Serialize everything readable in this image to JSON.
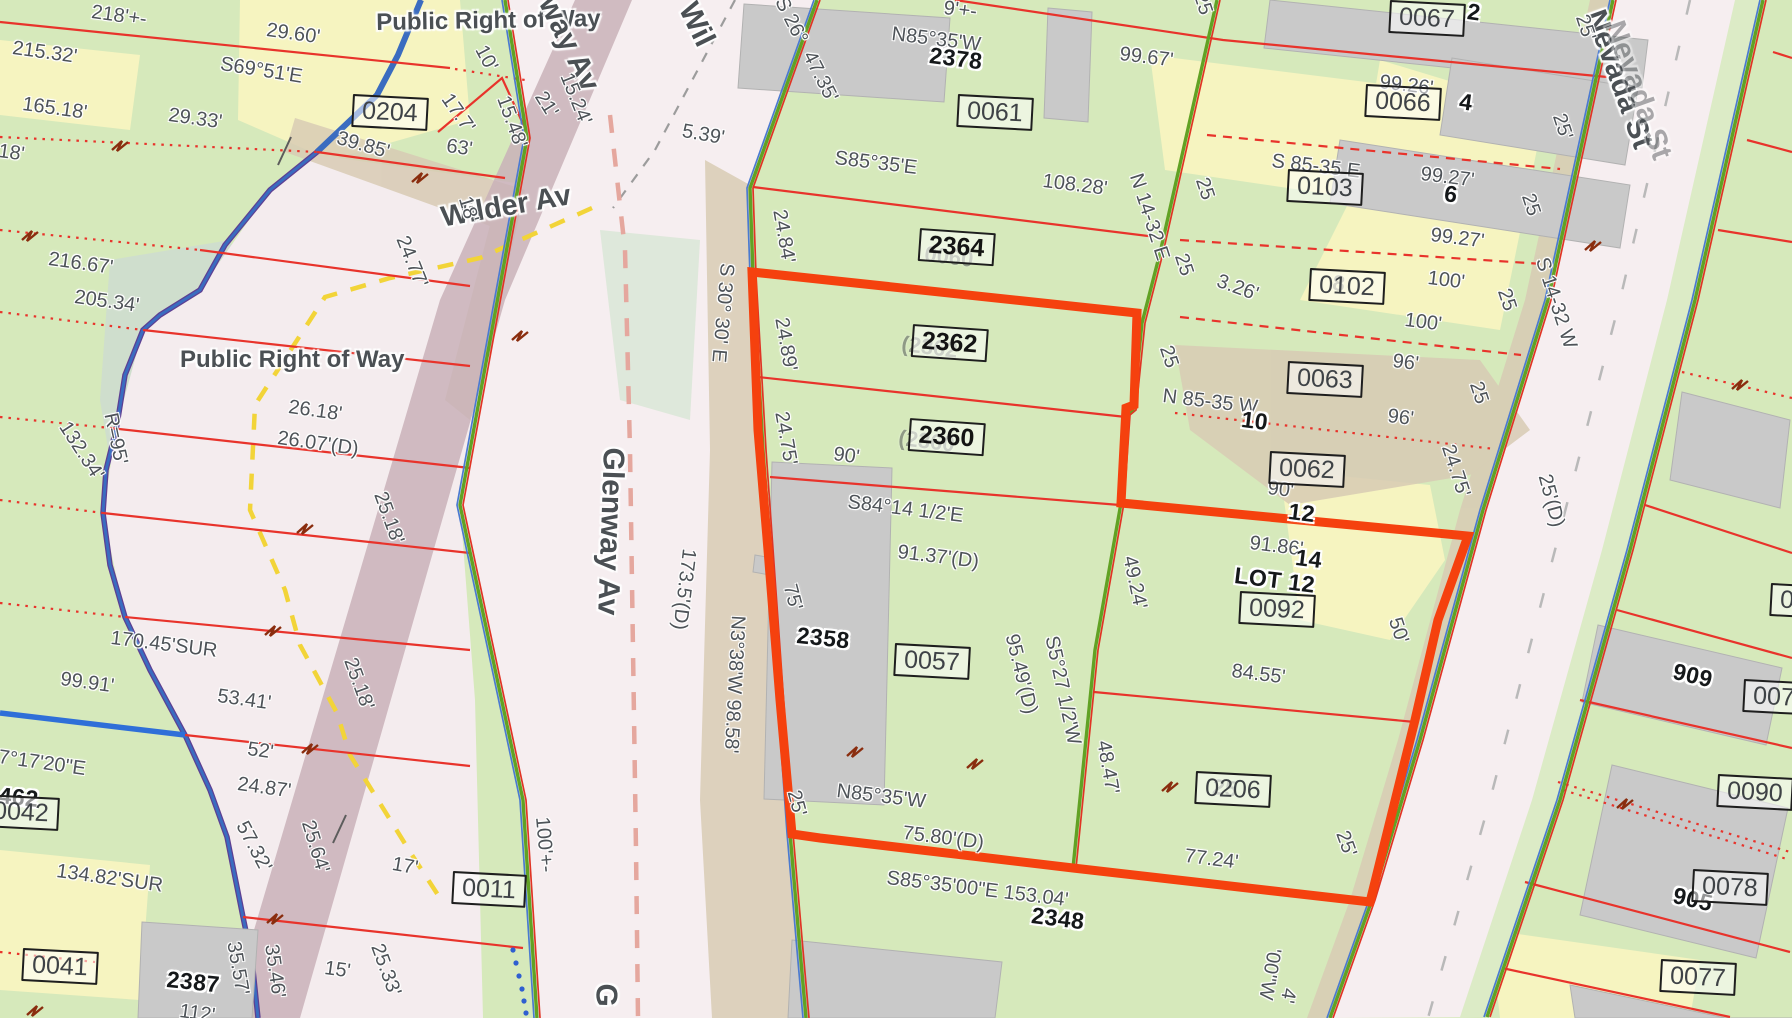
{
  "map": {
    "description": "County GIS parcel map with highlighted subject parcel",
    "colors": {
      "parcel_green": "#d6e9bb",
      "parcel_yellow": "#f6f4c0",
      "vegetation_sage": "#cfdecd",
      "road_pink": "#f6eef0",
      "road_mauve": "#c9b2b8",
      "verge_tan": "#d8cbb4",
      "highlight_red": "#f5410e",
      "lot_line_red": "#e8332b",
      "frontage_green": "#61a224",
      "stream_blue": "#3a6cc0",
      "stream_purple": "#5d3f92",
      "centerline_salmon": "#e5a79e",
      "guide_yellow": "#f2d438"
    },
    "street_labels": [
      {
        "t": "Public Right of Way",
        "x": 376,
        "y": 11,
        "r": -1,
        "s": 24,
        "o": 1
      },
      {
        "t": "Public Right of Way",
        "x": 180,
        "y": 348,
        "r": 0,
        "s": 24,
        "o": 1
      },
      {
        "t": "Wilder Av",
        "x": 439,
        "y": 204,
        "r": -10,
        "s": 29,
        "o": 1
      },
      {
        "t": "way Av",
        "x": 560,
        "y": -8,
        "r": 64,
        "s": 30,
        "o": 1
      },
      {
        "t": "Wil",
        "x": 700,
        "y": -2,
        "r": 64,
        "s": 30,
        "o": 1
      },
      {
        "t": "Glenway Av",
        "x": 628,
        "y": 448,
        "r": 92,
        "s": 30,
        "o": 1
      },
      {
        "t": "G",
        "x": 621,
        "y": 984,
        "r": 92,
        "s": 30,
        "o": 1
      },
      {
        "t": "Nevada St",
        "x": 1608,
        "y": 6,
        "r": 70,
        "s": 30,
        "o": 1
      },
      {
        "t": "Nevada St",
        "x": 1627,
        "y": 17,
        "r": 70,
        "s": 30,
        "o": 0.45
      }
    ],
    "parcel_boxes": [
      {
        "t": "0204",
        "x": 353,
        "y": 94,
        "r": 3,
        "b": false
      },
      {
        "t": "0061",
        "x": 958,
        "y": 94,
        "r": 3,
        "b": false
      },
      {
        "t": "0067",
        "x": 1390,
        "y": 0,
        "r": 3,
        "b": false
      },
      {
        "t": "0066",
        "x": 1366,
        "y": 84,
        "r": 3,
        "b": false
      },
      {
        "t": "0103",
        "x": 1288,
        "y": 169,
        "r": 3,
        "b": false
      },
      {
        "t": "0102",
        "x": 1310,
        "y": 268,
        "r": 3,
        "b": false
      },
      {
        "t": "0063",
        "x": 1288,
        "y": 361,
        "r": 3,
        "b": false
      },
      {
        "t": "0062",
        "x": 1270,
        "y": 451,
        "r": 3,
        "b": false
      },
      {
        "t": "0092",
        "x": 1240,
        "y": 591,
        "r": 3,
        "b": false
      },
      {
        "t": "0057",
        "x": 895,
        "y": 643,
        "r": 3,
        "b": false
      },
      {
        "t": "0206",
        "x": 1196,
        "y": 771,
        "r": 3,
        "b": false
      },
      {
        "t": "2364",
        "x": 920,
        "y": 228,
        "r": 4,
        "b": true
      },
      {
        "t": "2362",
        "x": 913,
        "y": 324,
        "r": 4,
        "b": true
      },
      {
        "t": "2360",
        "x": 910,
        "y": 418,
        "r": 4,
        "b": true
      },
      {
        "t": "0011",
        "x": 453,
        "y": 871,
        "r": 3,
        "b": false
      },
      {
        "t": "0041",
        "x": 23,
        "y": 948,
        "r": 3,
        "b": false
      },
      {
        "t": "0042",
        "x": -16,
        "y": 794,
        "r": 3,
        "b": false
      },
      {
        "t": "0090",
        "x": 1718,
        "y": 774,
        "r": 3,
        "b": false
      },
      {
        "t": "0078",
        "x": 1693,
        "y": 869,
        "r": 3,
        "b": false
      },
      {
        "t": "0077",
        "x": 1661,
        "y": 959,
        "r": 3,
        "b": false
      },
      {
        "t": "007",
        "x": 1744,
        "y": 679,
        "r": 3,
        "b": false
      },
      {
        "t": "0",
        "x": 1771,
        "y": 583,
        "r": 3,
        "b": false
      }
    ],
    "house_numbers": [
      {
        "t": "2378",
        "x": 931,
        "y": 44,
        "r": 7
      },
      {
        "t": "2358",
        "x": 798,
        "y": 624,
        "r": 6
      },
      {
        "t": "2348",
        "x": 1033,
        "y": 904,
        "r": 7
      },
      {
        "t": "2387",
        "x": 168,
        "y": 968,
        "r": 6
      },
      {
        "t": "909",
        "x": 1676,
        "y": 660,
        "r": 13
      },
      {
        "t": "905",
        "x": 1676,
        "y": 884,
        "r": 13
      },
      {
        "t": "2",
        "x": 1469,
        "y": 0,
        "r": 8
      },
      {
        "t": "4",
        "x": 1461,
        "y": 90,
        "r": 8
      },
      {
        "t": "6",
        "x": 1446,
        "y": 182,
        "r": 8
      },
      {
        "t": "10",
        "x": 1243,
        "y": 408,
        "r": 7
      },
      {
        "t": "12",
        "x": 1290,
        "y": 500,
        "r": 7
      },
      {
        "t": "14",
        "x": 1297,
        "y": 546,
        "r": 7
      },
      {
        "t": "462",
        "x": 0,
        "y": 784,
        "r": 6
      },
      {
        "t": "LOT 12",
        "x": 1236,
        "y": 564,
        "r": 7
      }
    ],
    "ghost_labels": [
      {
        "t": "0060",
        "x": 926,
        "y": 243,
        "r": 7
      },
      {
        "t": "(2362",
        "x": 903,
        "y": 333,
        "r": 7
      },
      {
        "t": "(2360",
        "x": 900,
        "y": 427,
        "r": 7
      },
      {
        "t": "8",
        "x": 1334,
        "y": 272,
        "r": 7
      },
      {
        "t": "25",
        "x": 1214,
        "y": 776,
        "r": 7
      }
    ],
    "dim_labels": [
      {
        "t": "218'+-",
        "x": 93,
        "y": 2,
        "r": 8
      },
      {
        "t": "29.60'",
        "x": 268,
        "y": 20,
        "r": 8
      },
      {
        "t": "215.32'",
        "x": 14,
        "y": 38,
        "r": 8
      },
      {
        "t": "S69°51'E",
        "x": 222,
        "y": 54,
        "r": 9
      },
      {
        "t": "165.18'",
        "x": 24,
        "y": 94,
        "r": 8
      },
      {
        "t": "29.33'",
        "x": 170,
        "y": 105,
        "r": 8
      },
      {
        "t": "39.85'",
        "x": 340,
        "y": 128,
        "r": 16
      },
      {
        "t": "18'",
        "x": 0,
        "y": 141,
        "r": 8
      },
      {
        "t": "216.67'",
        "x": 50,
        "y": 249,
        "r": 8
      },
      {
        "t": "205.34'",
        "x": 76,
        "y": 287,
        "r": 8
      },
      {
        "t": "132.34'",
        "x": 72,
        "y": 418,
        "r": 57
      },
      {
        "t": "R=95'",
        "x": 120,
        "y": 411,
        "r": 78
      },
      {
        "t": "26.18'",
        "x": 290,
        "y": 397,
        "r": 8
      },
      {
        "t": "26.07'(D)",
        "x": 279,
        "y": 428,
        "r": 8
      },
      {
        "t": "25.18'",
        "x": 389,
        "y": 489,
        "r": 70
      },
      {
        "t": "25.18'",
        "x": 359,
        "y": 655,
        "r": 70
      },
      {
        "t": "170.45'SUR",
        "x": 112,
        "y": 628,
        "r": 7
      },
      {
        "t": "99.91'",
        "x": 62,
        "y": 669,
        "r": 8
      },
      {
        "t": "53.41'",
        "x": 219,
        "y": 686,
        "r": 8
      },
      {
        "t": "52'",
        "x": 249,
        "y": 739,
        "r": 8
      },
      {
        "t": "24.87'",
        "x": 239,
        "y": 774,
        "r": 8
      },
      {
        "t": "7°17'20\"E",
        "x": 0,
        "y": 747,
        "r": 8
      },
      {
        "t": "134.82'SUR",
        "x": 58,
        "y": 861,
        "r": 8
      },
      {
        "t": "57.32'",
        "x": 250,
        "y": 818,
        "r": 62
      },
      {
        "t": "25.64'",
        "x": 317,
        "y": 818,
        "r": 73
      },
      {
        "t": "17'",
        "x": 394,
        "y": 854,
        "r": 10
      },
      {
        "t": "15'",
        "x": 326,
        "y": 958,
        "r": 8
      },
      {
        "t": "25.33'",
        "x": 386,
        "y": 941,
        "r": 70
      },
      {
        "t": "35.57'",
        "x": 243,
        "y": 940,
        "r": 80
      },
      {
        "t": "35.46'",
        "x": 281,
        "y": 943,
        "r": 82
      },
      {
        "t": "112'",
        "x": 181,
        "y": 1001,
        "r": 8
      },
      {
        "t": "100'+-",
        "x": 552,
        "y": 816,
        "r": 85
      },
      {
        "t": "10'",
        "x": 489,
        "y": 42,
        "r": 62
      },
      {
        "t": "17.7'",
        "x": 454,
        "y": 90,
        "r": 55
      },
      {
        "t": "63'",
        "x": 448,
        "y": 136,
        "r": 8
      },
      {
        "t": "15.48'",
        "x": 512,
        "y": 93,
        "r": 70
      },
      {
        "t": "21'",
        "x": 548,
        "y": 88,
        "r": 58
      },
      {
        "t": "15.24'",
        "x": 575,
        "y": 70,
        "r": 68
      },
      {
        "t": "18'",
        "x": 474,
        "y": 194,
        "r": 73
      },
      {
        "t": "24.77'",
        "x": 411,
        "y": 233,
        "r": 68
      },
      {
        "t": "5.39'",
        "x": 684,
        "y": 121,
        "r": 10
      },
      {
        "t": "S 26°",
        "x": 789,
        "y": -6,
        "r": 63
      },
      {
        "t": "47.35'",
        "x": 817,
        "y": 48,
        "r": 63
      },
      {
        "t": "S 30° 30' E",
        "x": 737,
        "y": 264,
        "r": 95
      },
      {
        "t": "24.84'",
        "x": 789,
        "y": 208,
        "r": 80
      },
      {
        "t": "24.89'",
        "x": 791,
        "y": 316,
        "r": 80
      },
      {
        "t": "24.75'",
        "x": 791,
        "y": 410,
        "r": 80
      },
      {
        "t": "75'",
        "x": 799,
        "y": 582,
        "r": 75
      },
      {
        "t": "25'",
        "x": 803,
        "y": 788,
        "r": 75
      },
      {
        "t": "173.5'(D)",
        "x": 699,
        "y": 550,
        "r": 97
      },
      {
        "t": "N3°38'W 98.58'",
        "x": 748,
        "y": 616,
        "r": 93
      },
      {
        "t": "90'",
        "x": 835,
        "y": 444,
        "r": 8
      },
      {
        "t": "S84°14 1/2'E",
        "x": 849,
        "y": 492,
        "r": 7
      },
      {
        "t": "91.37'(D)",
        "x": 899,
        "y": 542,
        "r": 7
      },
      {
        "t": "95.49'(D)",
        "x": 1021,
        "y": 632,
        "r": 76
      },
      {
        "t": "S5°27 1/2'W",
        "x": 1061,
        "y": 634,
        "r": 78
      },
      {
        "t": "N85°35'W",
        "x": 838,
        "y": 781,
        "r": 7
      },
      {
        "t": "75.80'(D)",
        "x": 904,
        "y": 823,
        "r": 7
      },
      {
        "t": "S85°35'00\"E 153.04'",
        "x": 888,
        "y": 868,
        "r": 7
      },
      {
        "t": "48.47'",
        "x": 1113,
        "y": 739,
        "r": 80
      },
      {
        "t": "49.24'",
        "x": 1139,
        "y": 554,
        "r": 78
      },
      {
        "t": "84.55'",
        "x": 1233,
        "y": 661,
        "r": 7
      },
      {
        "t": "77.24'",
        "x": 1186,
        "y": 846,
        "r": 7
      },
      {
        "t": "91.86'",
        "x": 1251,
        "y": 533,
        "r": 7
      },
      {
        "t": "90'",
        "x": 1269,
        "y": 478,
        "r": 7
      },
      {
        "t": "'00\"W",
        "x": 1284,
        "y": 950,
        "r": 100
      },
      {
        "t": "4'",
        "x": 1299,
        "y": 990,
        "r": 100
      },
      {
        "t": "N85°35'W",
        "x": 893,
        "y": 24,
        "r": 7
      },
      {
        "t": "S85°35'E",
        "x": 836,
        "y": 148,
        "r": 7
      },
      {
        "t": "108.28'",
        "x": 1044,
        "y": 171,
        "r": 7
      },
      {
        "t": "99.67'",
        "x": 1121,
        "y": 44,
        "r": 7
      },
      {
        "t": "9'+-",
        "x": 945,
        "y": -2,
        "r": 7
      },
      {
        "t": "N 14-32 E",
        "x": 1145,
        "y": 171,
        "r": 72
      },
      {
        "t": "3.26'",
        "x": 1221,
        "y": 271,
        "r": 20
      },
      {
        "t": "25",
        "x": 1209,
        "y": -10,
        "r": 72
      },
      {
        "t": "25",
        "x": 1211,
        "y": 175,
        "r": 72
      },
      {
        "t": "25",
        "x": 1190,
        "y": 251,
        "r": 72
      },
      {
        "t": "25",
        "x": 1175,
        "y": 343,
        "r": 72
      },
      {
        "t": "N 85-35 W",
        "x": 1164,
        "y": 386,
        "r": 7
      },
      {
        "t": "S 85-35 E",
        "x": 1273,
        "y": 151,
        "r": 7
      },
      {
        "t": "99.26'",
        "x": 1381,
        "y": 72,
        "r": 7
      },
      {
        "t": "99.27'",
        "x": 1422,
        "y": 164,
        "r": 7
      },
      {
        "t": "99.27'",
        "x": 1432,
        "y": 225,
        "r": 7
      },
      {
        "t": "100'",
        "x": 1429,
        "y": 268,
        "r": 7
      },
      {
        "t": "100'",
        "x": 1406,
        "y": 310,
        "r": 7
      },
      {
        "t": "96'",
        "x": 1394,
        "y": 351,
        "r": 7
      },
      {
        "t": "96'",
        "x": 1389,
        "y": 406,
        "r": 7
      },
      {
        "t": "25'",
        "x": 1591,
        "y": 12,
        "r": 72
      },
      {
        "t": "25'",
        "x": 1568,
        "y": 111,
        "r": 72
      },
      {
        "t": "25",
        "x": 1537,
        "y": 191,
        "r": 72
      },
      {
        "t": "25",
        "x": 1513,
        "y": 286,
        "r": 72
      },
      {
        "t": "25",
        "x": 1485,
        "y": 379,
        "r": 72
      },
      {
        "t": "24.75'",
        "x": 1457,
        "y": 442,
        "r": 72
      },
      {
        "t": "S 14-32 W",
        "x": 1551,
        "y": 255,
        "r": 72
      },
      {
        "t": "25'(D)",
        "x": 1554,
        "y": 472,
        "r": 75
      },
      {
        "t": "50'",
        "x": 1404,
        "y": 615,
        "r": 72
      },
      {
        "t": "25'",
        "x": 1351,
        "y": 828,
        "r": 70
      }
    ]
  }
}
